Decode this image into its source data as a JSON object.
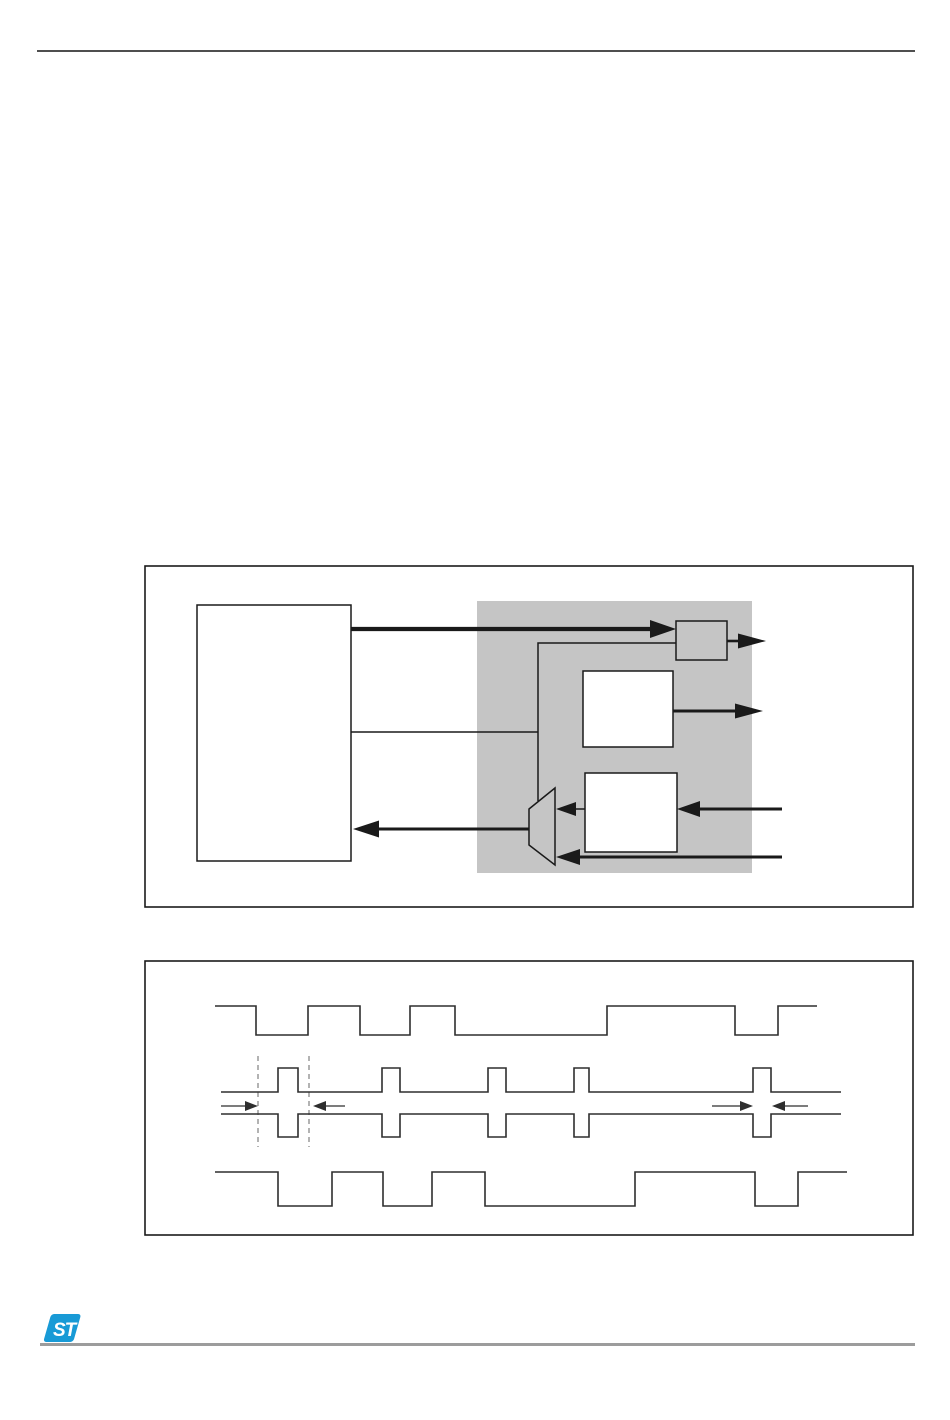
{
  "page": {
    "width": 950,
    "height": 1420,
    "background": "#ffffff"
  },
  "colors": {
    "line": "#1a1a1a",
    "wave": "#2e2e2e",
    "shade": "#c5c5c5",
    "white": "#ffffff",
    "dashed": "#8a8a8a",
    "header_rule": "#4f4f4f",
    "footer_rule": "#9c9c9c",
    "logo_blue": "#189ad6"
  },
  "header": {
    "rule": {
      "x": 37,
      "y": 50,
      "w": 878,
      "h": 2
    }
  },
  "footer": {
    "rule": {
      "x": 40,
      "y": 1343,
      "w": 875,
      "h": 3
    }
  },
  "logo": {
    "text": "ST",
    "x": 42,
    "y": 1313,
    "w": 46,
    "h": 31
  },
  "figure1": {
    "type": "block-diagram",
    "frame": {
      "x": 145,
      "y": 566,
      "w": 768,
      "h": 341
    },
    "shaded_region": {
      "x": 477,
      "y": 601,
      "w": 275,
      "h": 272
    },
    "blocks": [
      {
        "name": "left-large-block",
        "x": 197,
        "y": 605,
        "w": 154,
        "h": 256,
        "fill": "#ffffff"
      },
      {
        "name": "small-top-block",
        "x": 676,
        "y": 621,
        "w": 51,
        "h": 39,
        "fill": "#c5c5c5"
      },
      {
        "name": "middle-block",
        "x": 583,
        "y": 671,
        "w": 90,
        "h": 76,
        "fill": "#ffffff"
      },
      {
        "name": "lower-block",
        "x": 585,
        "y": 773,
        "w": 92,
        "h": 79,
        "fill": "#ffffff"
      }
    ],
    "mux": {
      "name": "mux",
      "points": [
        [
          529,
          809
        ],
        [
          555,
          788
        ],
        [
          555,
          865
        ],
        [
          529,
          845
        ]
      ],
      "fill": "#c5c5c5"
    },
    "lines": [
      {
        "name": "feedback-line",
        "points": [
          [
            676,
            643
          ],
          [
            538,
            643
          ],
          [
            538,
            801
          ]
        ],
        "width": 1.5
      },
      {
        "name": "select-line",
        "points": [
          [
            351,
            732
          ],
          [
            538,
            732
          ]
        ],
        "width": 1.5
      }
    ],
    "arrows": [
      {
        "name": "arrow-left-to-small-block",
        "x1": 351,
        "x2": 676,
        "y": 629,
        "shaft": 4.2,
        "head": [
          26,
          18
        ]
      },
      {
        "name": "arrow-small-block-output",
        "x1": 727,
        "x2": 766,
        "y": 641,
        "shaft": 2.6,
        "head": [
          28,
          15
        ]
      },
      {
        "name": "arrow-middle-block-output",
        "x1": 673,
        "x2": 763,
        "y": 711,
        "shaft": 3,
        "head": [
          28,
          15
        ]
      },
      {
        "name": "arrow-input-to-lower-block",
        "x1": 782,
        "x2": 677,
        "y": 809,
        "shaft": 3,
        "head": [
          23,
          16
        ]
      },
      {
        "name": "arrow-lower-block-to-mux",
        "x1": 585,
        "x2": 556,
        "y": 809,
        "shaft": 1.5,
        "head": [
          20,
          14
        ]
      },
      {
        "name": "arrow-input-to-mux",
        "x1": 782,
        "x2": 556,
        "y": 857,
        "shaft": 3,
        "head": [
          24,
          16
        ]
      },
      {
        "name": "arrow-mux-to-left-block",
        "x1": 529,
        "x2": 353,
        "y": 829,
        "shaft": 3,
        "head": [
          26,
          17
        ]
      }
    ]
  },
  "figure2": {
    "type": "timing-diagram",
    "frame": {
      "x": 145,
      "y": 961,
      "w": 768,
      "h": 274
    },
    "waveforms": [
      {
        "name": "top-waveform",
        "style": "square",
        "high": 1006,
        "low": 1035,
        "initial": "high",
        "start_x": 215,
        "end_x": 817,
        "transitions": [
          256,
          308,
          360,
          410,
          455,
          607,
          735,
          778
        ]
      },
      {
        "name": "bottom-waveform",
        "style": "square",
        "high": 1172,
        "low": 1206,
        "initial": "high",
        "start_x": 215,
        "end_x": 847,
        "transitions": [
          278,
          332,
          383,
          432,
          485,
          635,
          755,
          798
        ]
      }
    ],
    "pulse_waveform": {
      "name": "middle-pulse-waveform",
      "rail_top": 1092,
      "rail_bottom": 1114,
      "pulse_top": 1068,
      "pulse_bottom": 1137,
      "start_x": 221,
      "end_x": 841,
      "pulses": [
        [
          278,
          298
        ],
        [
          382,
          400
        ],
        [
          488,
          506
        ],
        [
          574,
          589
        ],
        [
          753,
          771
        ]
      ]
    },
    "dashed_lines": [
      {
        "name": "dashed-marker-1",
        "x": 258,
        "y1": 1056,
        "y2": 1147
      },
      {
        "name": "dashed-marker-2",
        "x": 309,
        "y1": 1056,
        "y2": 1147
      }
    ],
    "measure_arrows": [
      {
        "name": "measure-arrow-left-in",
        "x1": 221,
        "x2": 258,
        "y": 1106,
        "shaft": 1.3,
        "head": [
          13,
          10
        ]
      },
      {
        "name": "measure-arrow-left-out",
        "x1": 345,
        "x2": 313,
        "y": 1106,
        "shaft": 1.3,
        "head": [
          13,
          10
        ]
      },
      {
        "name": "measure-arrow-right-in",
        "x1": 712,
        "x2": 753,
        "y": 1106,
        "shaft": 1.3,
        "head": [
          13,
          10
        ]
      },
      {
        "name": "measure-arrow-right-out",
        "x1": 808,
        "x2": 772,
        "y": 1106,
        "shaft": 1.3,
        "head": [
          13,
          10
        ]
      }
    ]
  }
}
